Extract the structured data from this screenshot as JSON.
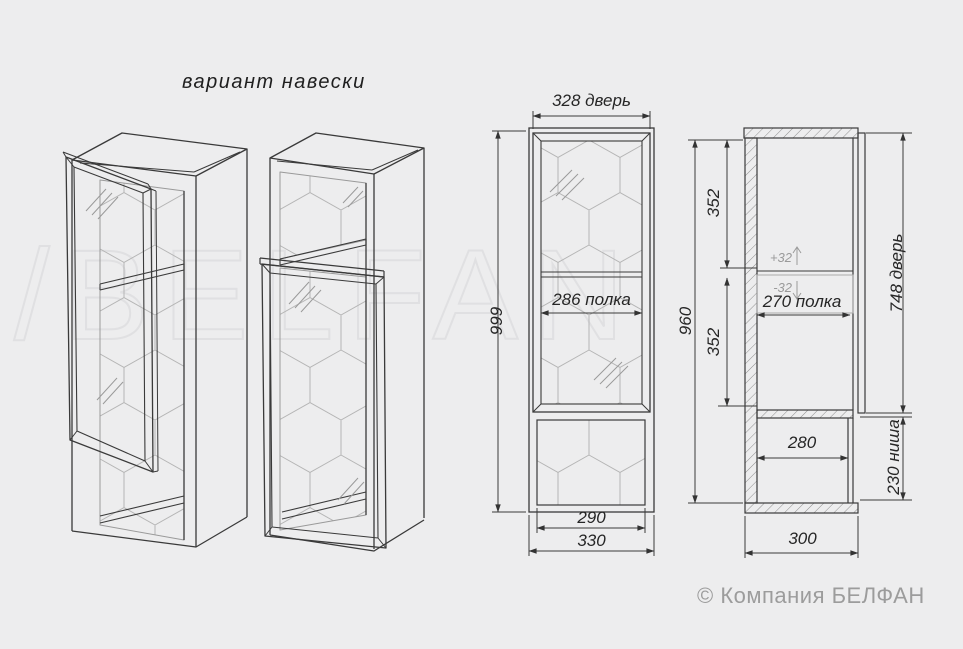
{
  "title": "вариант навески",
  "watermark": "/BELFAN",
  "copyright": "© Компания БЕЛФАН",
  "front_view": {
    "dim_door_width": "328 дверь",
    "dim_height": "999",
    "dim_shelf": "286 полка",
    "dim_niche_width": "290",
    "dim_width": "330"
  },
  "side_view": {
    "dim_top_section": "352",
    "dim_bottom_section": "352",
    "dim_height": "960",
    "dim_shelf_plus": "+32",
    "dim_shelf_minus": "-32",
    "dim_shelf_depth": "270 полка",
    "dim_door_height": "748 дверь",
    "dim_niche_height": "230 ниша",
    "dim_niche_depth": "280",
    "dim_depth": "300"
  },
  "colors": {
    "background": "#ededee",
    "line": "#3a3a3a",
    "pattern": "#b5b5b5",
    "muted": "#9a9a9a",
    "watermark": "#e0e0e2"
  }
}
